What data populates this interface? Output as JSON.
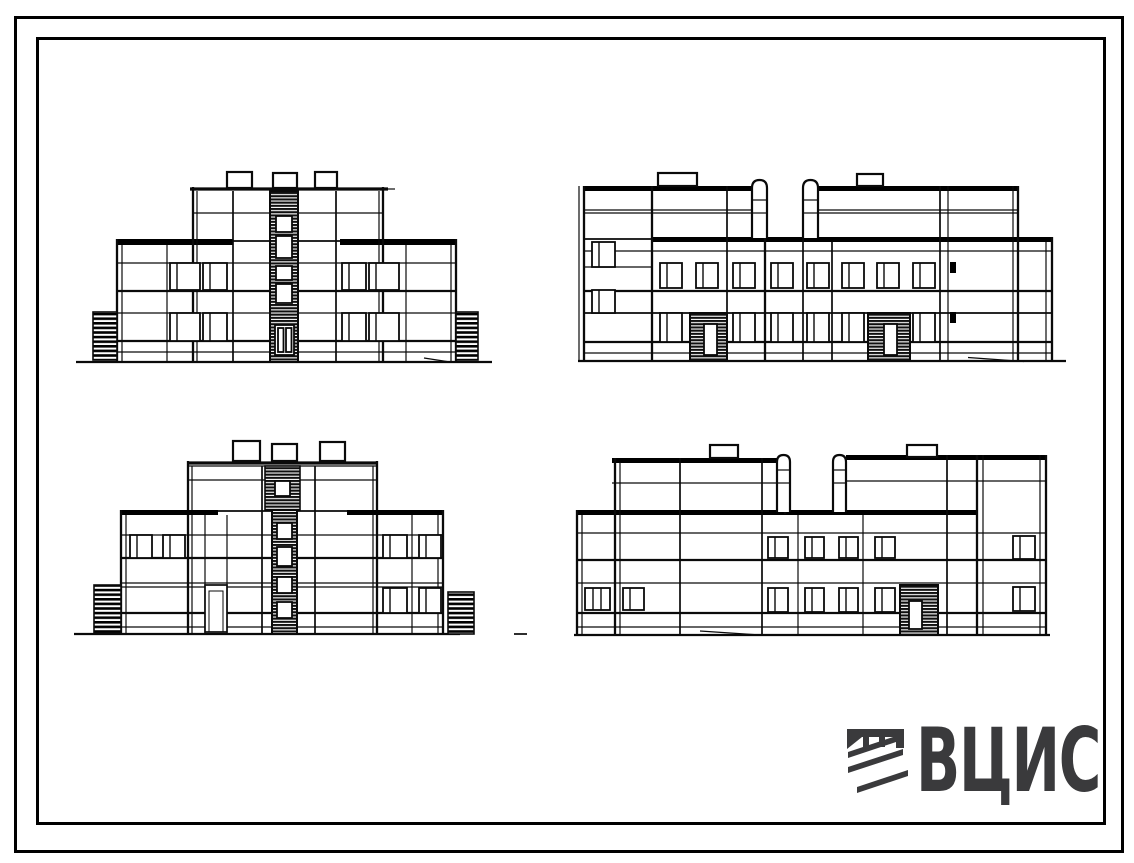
{
  "document": {
    "kind": "architectural elevation sheet",
    "description": "Black-and-white line drawing sheet with four facade elevations of a two-storey panel building with raised central and end stair blocks, framed by a double border, with the ВЦИС logo in the lower right corner"
  },
  "colors": {
    "paper": "#ffffff",
    "ink": "#000000",
    "logo": "#3a3a3c"
  },
  "logo": {
    "text": "ВЦИС",
    "color": "#3a3a3c",
    "emblem_icon": "vcis-stripes-emblem"
  },
  "elevations": [
    {
      "position": "top-left",
      "name": "front elevation",
      "description": "Symmetric two-storey facade, raised three-level centre block with hatched stair strip, entrance door, three roof boxes, paired windows on both floors, hatched side ramps"
    },
    {
      "position": "top-right",
      "name": "side elevation A",
      "description": "Long two-storey facade with eight upper windows, six lower windows, two dark hatched entrances, two round-top vent stacks and two roof boxes"
    },
    {
      "position": "bottom-left",
      "name": "rear elevation",
      "description": "Symmetric two-storey facade with dark hatched central stair strip and small square stair windows, rear door, three roof boxes, hatched side ramps"
    },
    {
      "position": "bottom-right",
      "name": "side elevation B",
      "description": "Long two-storey facade with four upper and four lower windows, one dark hatched entrance, two round-top vent stacks and two roof boxes"
    }
  ]
}
